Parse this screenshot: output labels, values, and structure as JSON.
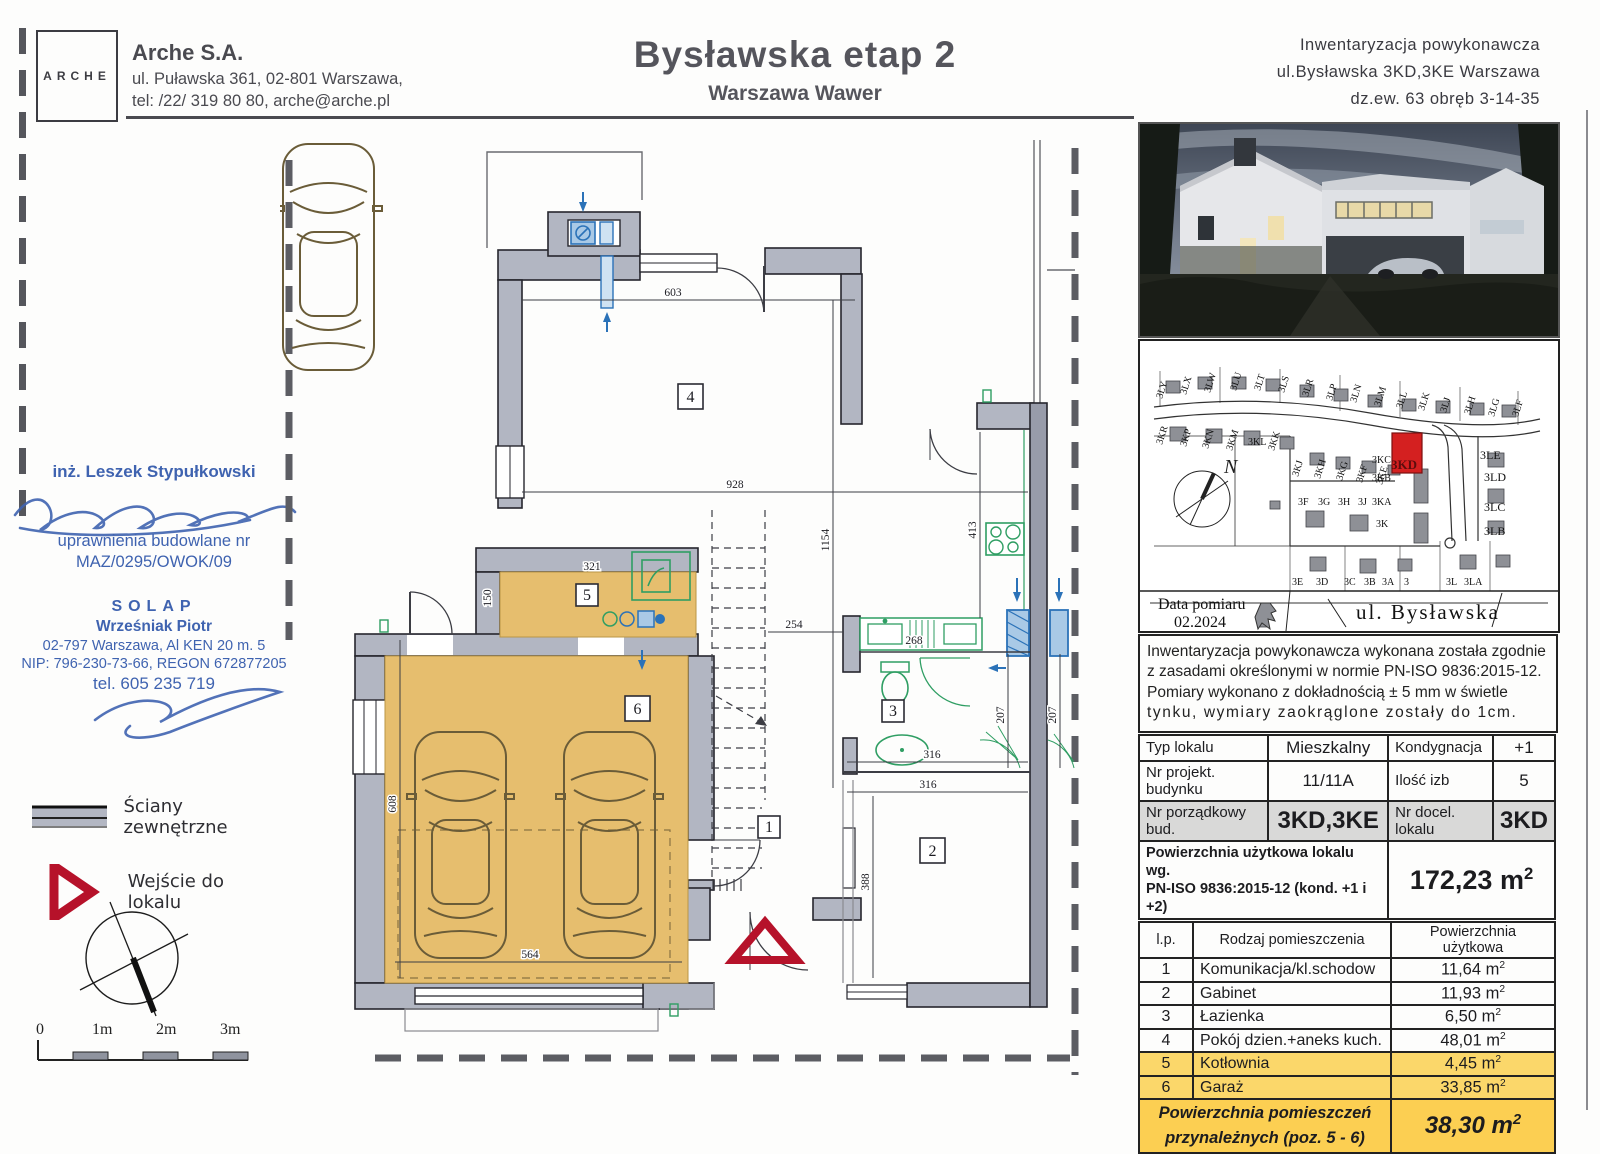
{
  "header": {
    "logo": "ARCHE",
    "company_name": "Arche S.A.",
    "address": "ul. Puławska 361, 02-801 Warszawa,",
    "phone": "tel: /22/ 319 80 80, arche@arche.pl",
    "title": "Bysławska etap 2",
    "subtitle": "Warszawa Wawer",
    "right1": "Inwentaryzacja powykonawcza",
    "right2": "ul.Bysławska 3KD,3KE Warszawa",
    "right3": "dz.ew. 63 obręb 3-14-35"
  },
  "surveyor": {
    "engineer": "inż. Leszek Stypułkowski",
    "permit1": "uprawnienia budowlane nr",
    "permit2": "MAZ/0295/OWOK/09",
    "firm": "SOLAP",
    "person": "Wrześniak Piotr",
    "firm_addr": "02-797 Warszawa, Al KEN 20 m. 5",
    "firm_ids": "NIP: 796-230-73-66, REGON 672877205",
    "firm_tel": "tel. 605 235 719"
  },
  "legend": {
    "walls": "Ściany zewnętrzne",
    "entrance": "Wejście do lokalu"
  },
  "scalebar": {
    "l0": "0",
    "l1": "1m",
    "l2": "2m",
    "l3": "3m"
  },
  "map": {
    "north": "N",
    "date_label": "Data pomiaru",
    "date": "02.2024",
    "street": "ul. Bysławska",
    "highlight": "3KD",
    "top_lots": [
      "3LY",
      "3LX",
      "3LW",
      "3LU",
      "3LT",
      "3LS",
      "3LR",
      "3LP",
      "3LN",
      "3LM",
      "3LL",
      "3LK",
      "3LJ",
      "3LH",
      "3LG",
      "3LF"
    ],
    "row2_lots": [
      "3KR",
      "3KP",
      "3KN",
      "3KM",
      "3KL",
      "3KK"
    ],
    "mid_lots": [
      "3KJ",
      "3KH",
      "3KG",
      "3KF",
      "3KE"
    ],
    "stack_lots": [
      "3KC",
      "3KB",
      "3KA",
      "3K"
    ],
    "left_cluster": [
      "3F",
      "3G",
      "3H",
      "3J"
    ],
    "bottom_lots": [
      "3E",
      "3D",
      "3C",
      "3B",
      "3A",
      "3",
      "3L",
      "3LA"
    ],
    "right_lots": [
      "3LE",
      "3LD",
      "3LC",
      "3LB"
    ]
  },
  "note": {
    "line1": "Inwentaryzacja powykonawcza wykonana została zgodnie",
    "line2": "z zasadami określonymi w normie PN-ISO 9836:2015-12.",
    "line3": "Pomiary wykonano z dokładnością ± 5 mm w świetle",
    "line4": "tynku, wymiary zaokrąglone zostały do 1cm."
  },
  "units": {
    "m": "m",
    "exp": "2"
  },
  "info_table": {
    "r1c1": "Typ lokalu",
    "r1c2": "Mieszkalny",
    "r1c3": "Kondygnacja",
    "r1c4": "+1",
    "r2c1": "Nr projekt. budynku",
    "r2c2": "11/11A",
    "r2c3": "Ilość izb",
    "r2c4": "5",
    "r3c1": "Nr porządkowy bud.",
    "r3c2": "3KD,3KE",
    "r3c3": "Nr docel. lokalu",
    "r3c4": "3KD",
    "area_label1": "Powierzchnia użytkowa lokalu wg.",
    "area_label2": "PN-ISO 9836:2015-12 (kond. +1 i +2)",
    "area_value": "172,23"
  },
  "rooms_table": {
    "h1": "l.p.",
    "h2": "Rodzaj pomieszczenia",
    "h3": "Powierzchnia użytkowa",
    "rows": [
      {
        "no": "1",
        "name": "Komunikacja/kl.schodow",
        "area": "11,64"
      },
      {
        "no": "2",
        "name": "Gabinet",
        "area": "11,93"
      },
      {
        "no": "3",
        "name": "Łazienka",
        "area": "6,50"
      },
      {
        "no": "4",
        "name": "Pokój dzien.+aneks kuch.",
        "area": "48,01"
      },
      {
        "no": "5",
        "name": "Kotłownia",
        "area": "4,45"
      },
      {
        "no": "6",
        "name": "Garaż",
        "area": "33,85"
      }
    ],
    "foot1": "Powierzchnia pomieszczeń",
    "foot2": "przynależnych (poz. 5 - 6)",
    "foot_value": "38,30"
  },
  "plan": {
    "rooms": {
      "r1": "1",
      "r2": "2",
      "r3": "3",
      "r4": "4",
      "r5": "5",
      "r6": "6"
    },
    "dims": {
      "d603": "603",
      "d928": "928",
      "d1154": "1154",
      "d413": "413",
      "d321": "321",
      "d150": "150",
      "d254": "254",
      "d268": "268",
      "d316a": "316",
      "d316b": "316",
      "d207a": "207",
      "d207b": "207",
      "d388": "388",
      "d564": "564",
      "d608": "608"
    }
  }
}
